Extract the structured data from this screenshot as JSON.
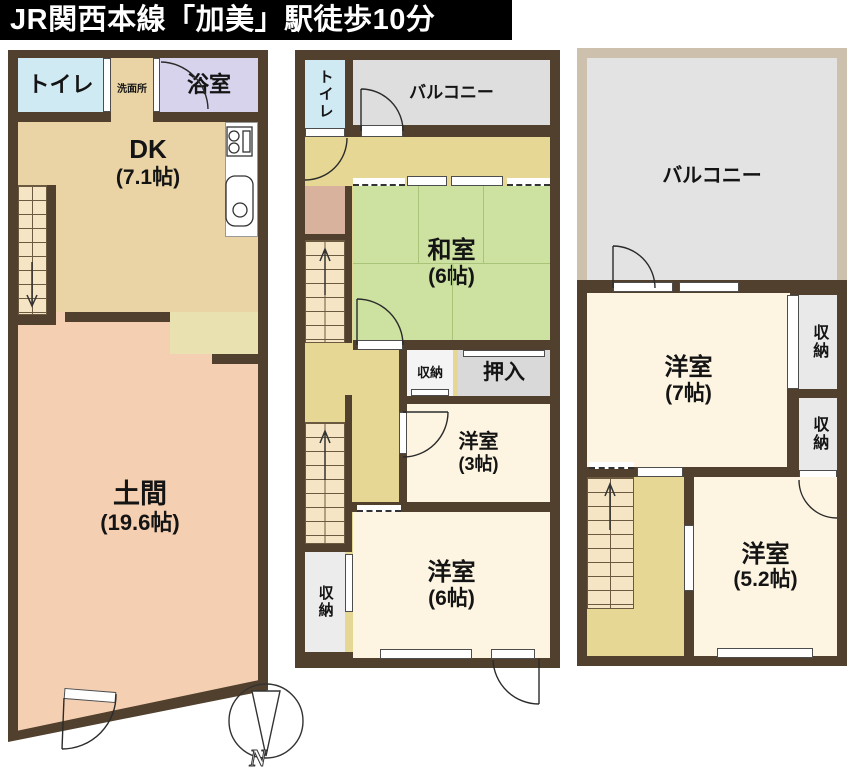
{
  "title": "JR関西本線「加美」駅徒歩10分",
  "units": {
    "first": {
      "toilet": "トイレ",
      "washroom": "洗面所",
      "bath": "浴室",
      "dk": {
        "name": "DK",
        "size": "(7.1帖)"
      },
      "doma": {
        "name": "土間",
        "size": "(19.6帖)"
      }
    },
    "second": {
      "toilet": "トイレ",
      "balcony": "バルコニー",
      "washitsu": {
        "name": "和室",
        "size": "(6帖)"
      },
      "storage_mid": "収納",
      "oshiire": "押入",
      "western3": {
        "name": "洋室",
        "size": "(3帖)"
      },
      "western6": {
        "name": "洋室",
        "size": "(6帖)"
      },
      "storage_left": "収納"
    },
    "third": {
      "balcony": "バルコニー",
      "western7": {
        "name": "洋室",
        "size": "(7帖)"
      },
      "storage_top": "収納",
      "storage_mid": "収納",
      "western52": {
        "name": "洋室",
        "size": "(5.2帖)"
      }
    }
  },
  "compass": {
    "north": "N"
  },
  "colors": {
    "wall": "#51402d",
    "title_bg": "#000000",
    "title_text": "#ffffff",
    "dk_floor": "#ead4a5",
    "doma_floor": "#f5cfb2",
    "toilet": "#cfeaf2",
    "bath": "#d7d3ec",
    "tatami": "#cde2a0",
    "hallway": "#e7d794",
    "western_floor": "#fdf5e2",
    "balcony_2f": "#dedede",
    "balcony_3f": "#e3e3e3",
    "closet": "#d9d9d9",
    "storage": "#ececec",
    "stairs": "#f6e5c4",
    "balcony_frame": "#cdc1ae",
    "pale_area": "#eae1b0",
    "hall_nook": "#d8b29c"
  }
}
